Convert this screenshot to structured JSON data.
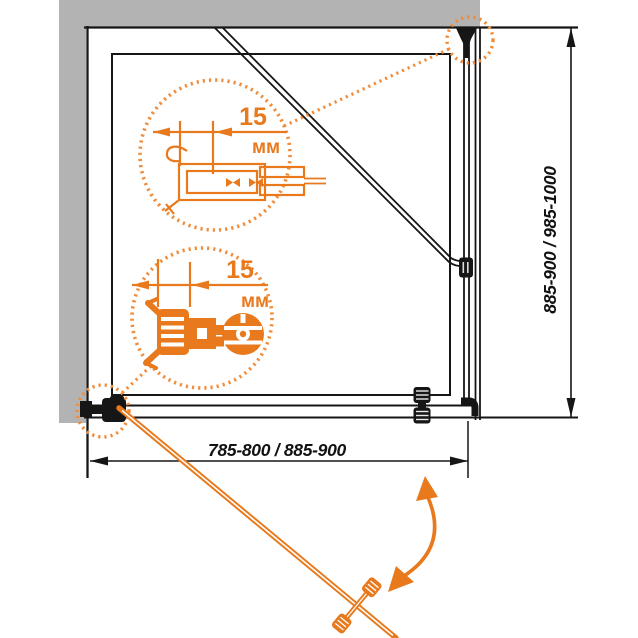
{
  "meta": {
    "title": "Shower enclosure installation diagram (top view)"
  },
  "dimensions": {
    "width_range": "785-800 / 885-900",
    "height_range": "885-900 / 985-1000"
  },
  "callouts": {
    "wall_profile": {
      "value": "15",
      "unit": "мм"
    },
    "door_hinge": {
      "value": "15",
      "unit": "мм"
    }
  },
  "colors": {
    "accent_orange": "#e8791d",
    "dotted_orange": "#f08d3c",
    "wall_gray": "#b3b3b3",
    "line_black": "#161616"
  }
}
